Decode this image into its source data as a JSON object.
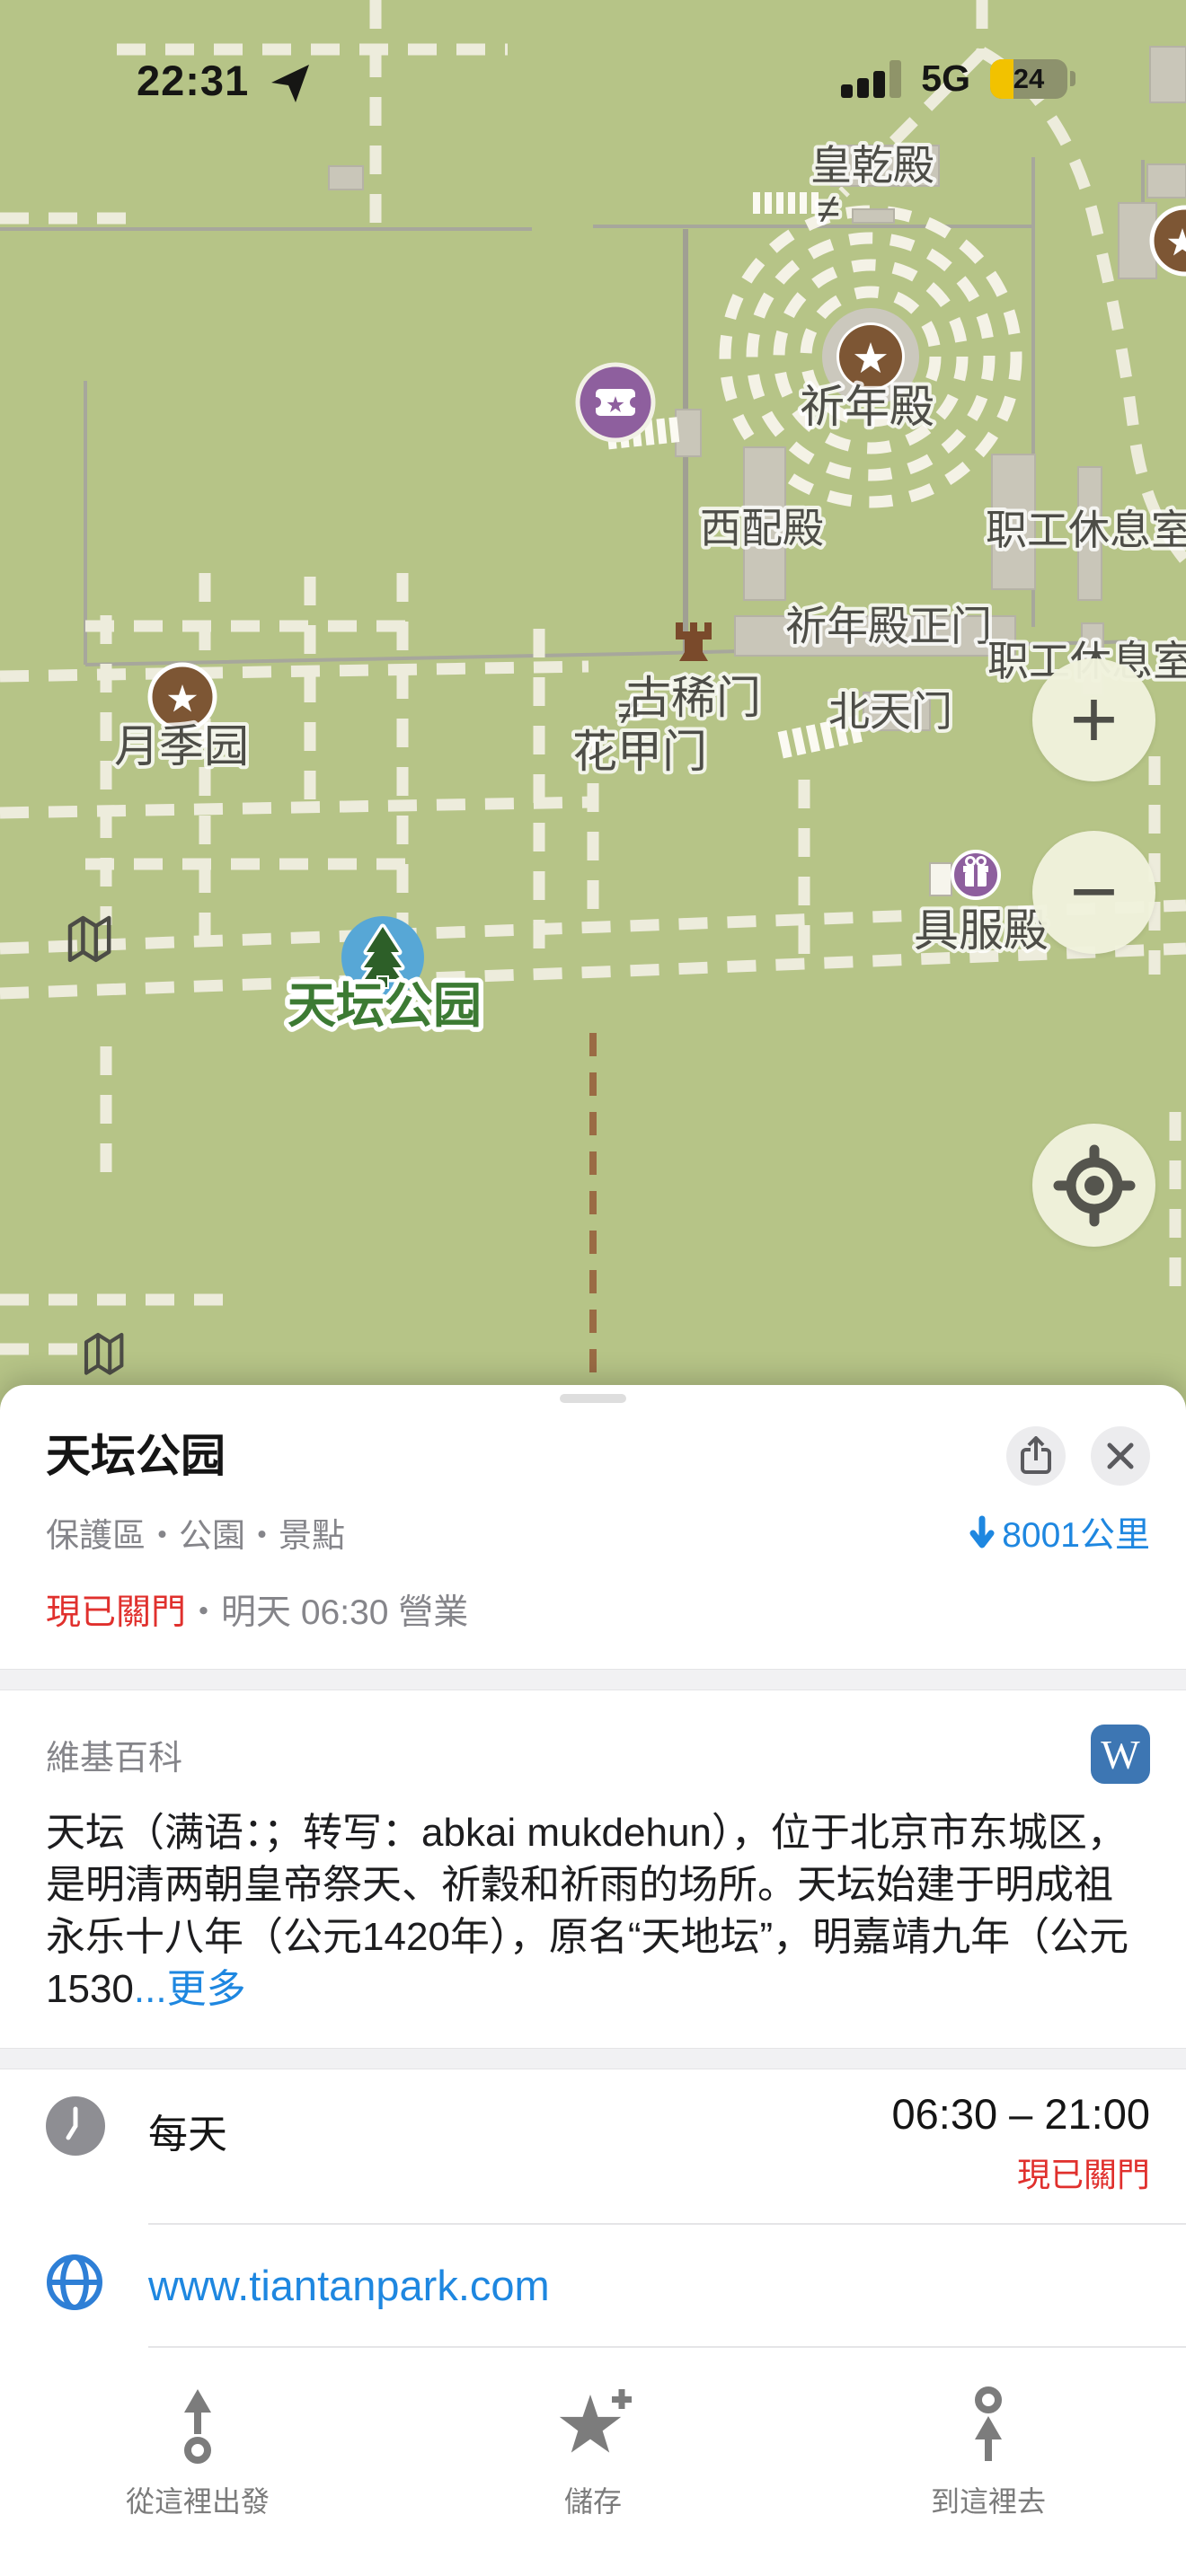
{
  "status_bar": {
    "time": "22:31",
    "network": "5G",
    "battery_percent": "24"
  },
  "map": {
    "labels": {
      "huangqiandian": "皇乾殿",
      "qiniandian": "祈年殿",
      "xipeidian": "西配殿",
      "zhigong_1": "职工休息室",
      "qiniandian_gate": "祈年殿正门",
      "zhigong_2": "职工休息室",
      "guximen": "古稀门",
      "beitianmen": "北天门",
      "huajiamen": "花甲门",
      "yuejiyuan": "月季园",
      "jufudian": "具服殿",
      "park": "天坛公园",
      "not_equal": "≠"
    },
    "controls": {
      "zoom_in": "+",
      "zoom_out": "−"
    },
    "colors": {
      "ground": "#b6c487",
      "poi_brown": "#7d5634",
      "poi_purple": "#8e5f9e",
      "pin_blue": "#57a7d6",
      "park_label_green": "#3c7a33"
    }
  },
  "sheet": {
    "title": "天坛公园",
    "category": "保護區・公園・景點",
    "distance": "8001公里",
    "status": {
      "closed": "現已關門",
      "separator": "・",
      "opens": "明天 06:30 營業"
    },
    "wikipedia": {
      "header": "維基百科",
      "icon_letter": "W",
      "excerpt": "天坛（满语：；转写：abkai mukdehun），位于北京市东城区，是明清两朝皇帝祭天、祈穀和祈雨的场所。天坛始建于明成祖永乐十八年（公元1420年），原名“天地坛”，明嘉靖九年（公元1530",
      "more_link": "...更多"
    },
    "hours": {
      "label": "每天",
      "time": "06:30 – 21:00",
      "status": "現已關門"
    },
    "website": "www.tiantanpark.com"
  },
  "toolbar": {
    "items": [
      {
        "label": "從這裡出發"
      },
      {
        "label": "儲存"
      },
      {
        "label": "到這裡去"
      }
    ]
  },
  "colors": {
    "accent_blue": "#1e87e0",
    "closed_red": "#e0302d",
    "battery_yellow": "#f2c200",
    "wikipedia_blue": "#3d76b3"
  }
}
